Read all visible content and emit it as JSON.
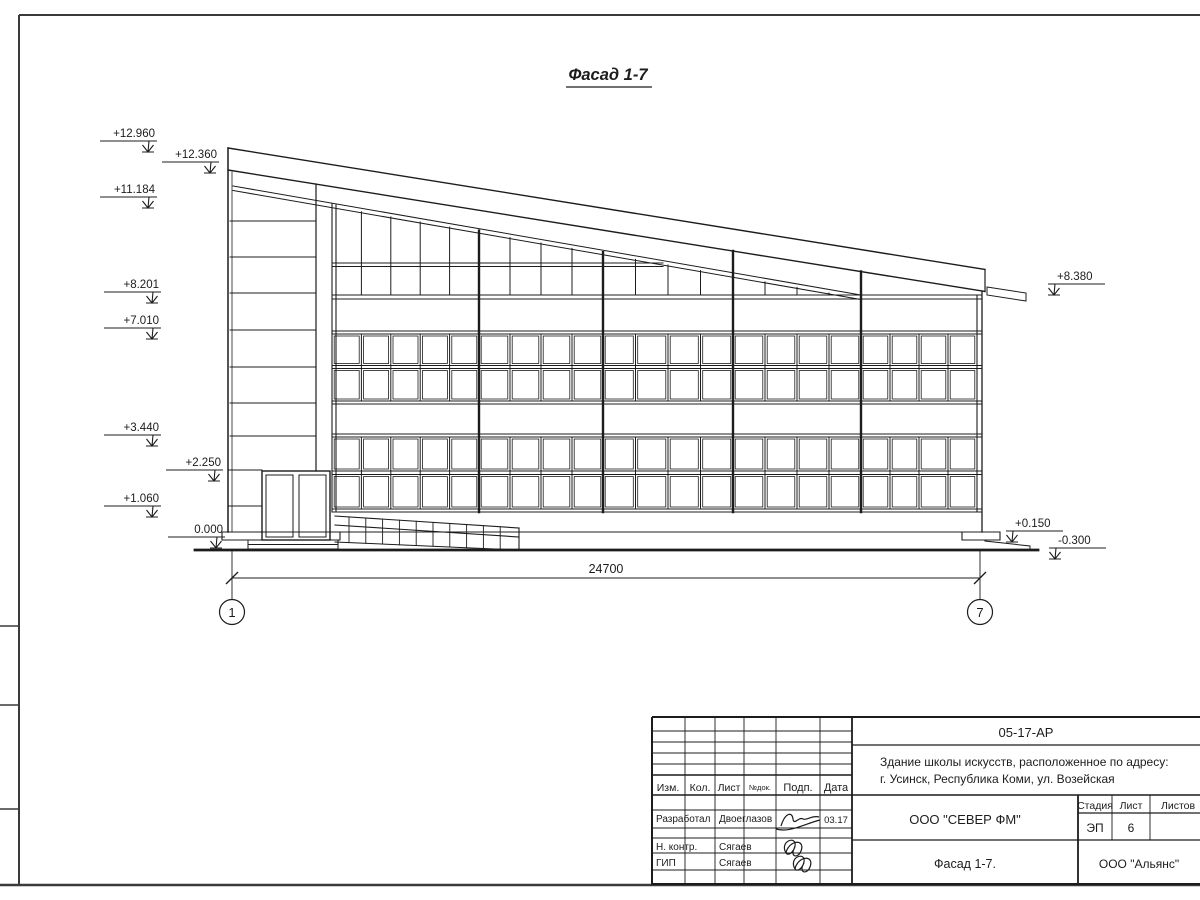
{
  "sheet": {
    "title": "Фасад 1-7",
    "dimension": "24700",
    "axis_left": "1",
    "axis_right": "7"
  },
  "elevations": {
    "left": [
      "+12.960",
      "+12.360",
      "+11.184",
      "+8.201",
      "+7.010",
      "+3.440",
      "+2.250",
      "+1.060",
      "0.000"
    ],
    "right": [
      "+8.380",
      "+0.150",
      "-0.300"
    ]
  },
  "title_block": {
    "doc_number": "05-17-АР",
    "project_line1": "Здание школы искусств, расположенное по адресу:",
    "project_line2": "г. Усинск, Республика Коми, ул. Возейская",
    "col_izm": "Изм.",
    "col_kol": "Кол.",
    "col_list": "Лист",
    "col_doc": "№док.",
    "col_podp": "Подп.",
    "col_data": "Дата",
    "rows": [
      {
        "role": "Разработал",
        "name": "Двоеглазов",
        "date": "03.17"
      },
      {
        "role": "Н. контр.",
        "name": "Сягаев",
        "date": ""
      },
      {
        "role": "ГИП",
        "name": "Сягаев",
        "date": ""
      }
    ],
    "org": "ООО \"СЕВЕР ФМ\"",
    "stage_label": "Стадия",
    "sheet_label": "Лист",
    "sheets_label": "Листов",
    "stage": "ЭП",
    "sheet_no": "6",
    "sheets_total": "",
    "drawing_title": "Фасад 1-7.",
    "firm": "ООО \"Альянс\""
  },
  "colors": {
    "line": "#1c1c1c",
    "frame": "#3a3a3a",
    "paper": "#ffffff"
  }
}
